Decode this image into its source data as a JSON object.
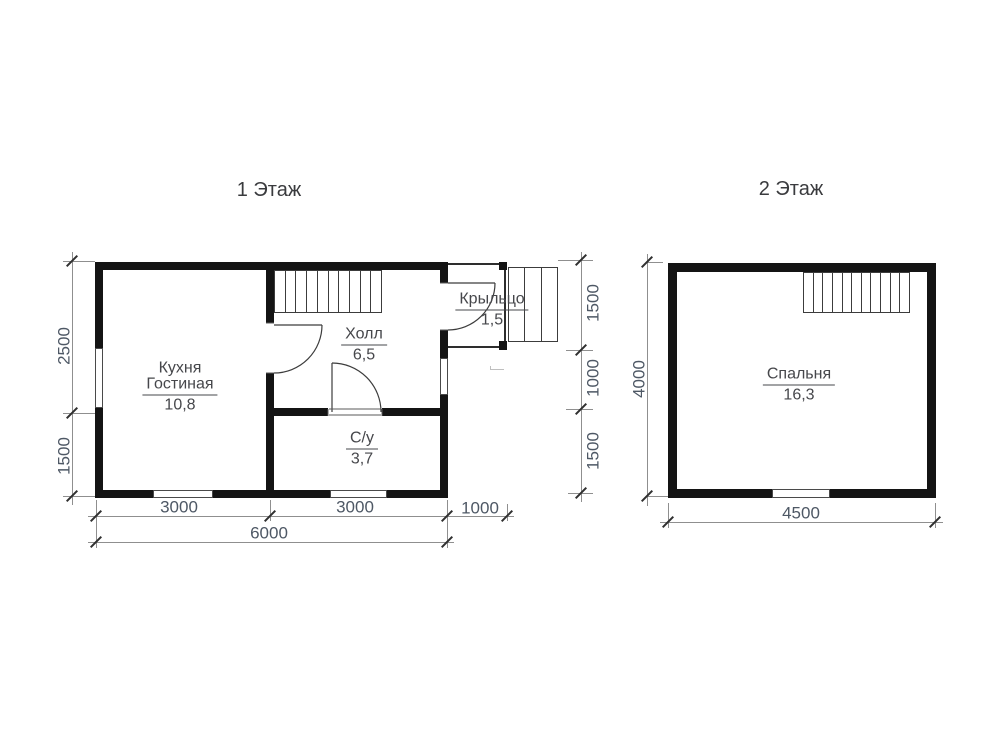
{
  "floor1": {
    "title": "1 Этаж",
    "rooms": {
      "kitchen_living": {
        "line1": "Кухня",
        "line2": "Гостиная",
        "area": "10,8"
      },
      "hall": {
        "name": "Холл",
        "area": "6,5"
      },
      "bathroom": {
        "name": "С/у",
        "area": "3,7"
      },
      "porch": {
        "name": "Крыльцо",
        "area": "1,5"
      }
    },
    "dims": {
      "left_upper": "2500",
      "left_lower": "1500",
      "right_upper": "1500",
      "right_middle": "1000",
      "right_lower": "1500",
      "bottom_left": "3000",
      "bottom_right": "3000",
      "bottom_porch": "1000",
      "bottom_total": "6000"
    }
  },
  "floor2": {
    "title": "2 Этаж",
    "rooms": {
      "bedroom": {
        "name": "Спальня",
        "area": "16,3"
      }
    },
    "dims": {
      "left": "4000",
      "bottom": "4500"
    }
  },
  "colors": {
    "wall": "#141414",
    "thin_line": "#3c3c3c",
    "dim_line": "#8f8f8f",
    "dim_text": "#4e5865",
    "label_text": "#46474b"
  }
}
